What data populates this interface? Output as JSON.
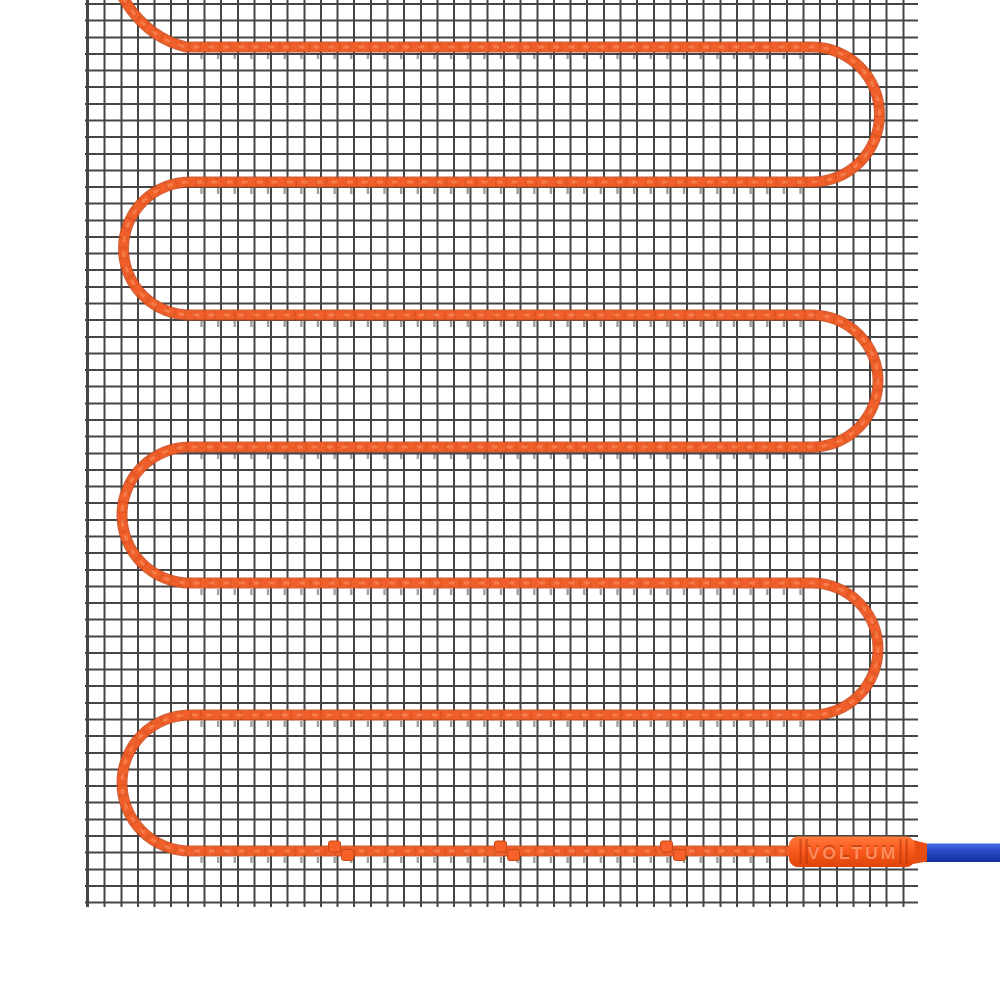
{
  "scene": {
    "type": "product-render",
    "subject": "electric underfloor heating mat: mesh grid with serpentine heating cable, fixing clips, splice connector and blue cold-lead wire",
    "brand_label": "VOLTUM"
  },
  "colors": {
    "background": "#ffffff",
    "mesh_line": "#454545",
    "cable_main": "#f05f2a",
    "cable_shade": "#d14e1a",
    "cable_outline": "#c2451a",
    "cable_highlight": "#ff9a67",
    "connector_body": "#fb5a1e",
    "connector_label": "#ff8f62",
    "cold_lead_blue": "#2b4ecb"
  },
  "geometry": {
    "mesh": {
      "left": 85,
      "top": 0,
      "width": 833,
      "height": 907,
      "cell_px": 16.64,
      "line_px": 2
    },
    "cable_rows_y": [
      47,
      182,
      315,
      447,
      583,
      715,
      851
    ],
    "turn_apex_left_x": 123,
    "turn_apex_right_x": 880,
    "clip_centers_x": [
      341,
      507,
      673
    ],
    "connector": {
      "x": 789,
      "y": 836,
      "width": 126,
      "height": 31
    },
    "cold_lead": {
      "x": 912,
      "y": 843,
      "width": 88,
      "height": 19
    }
  }
}
